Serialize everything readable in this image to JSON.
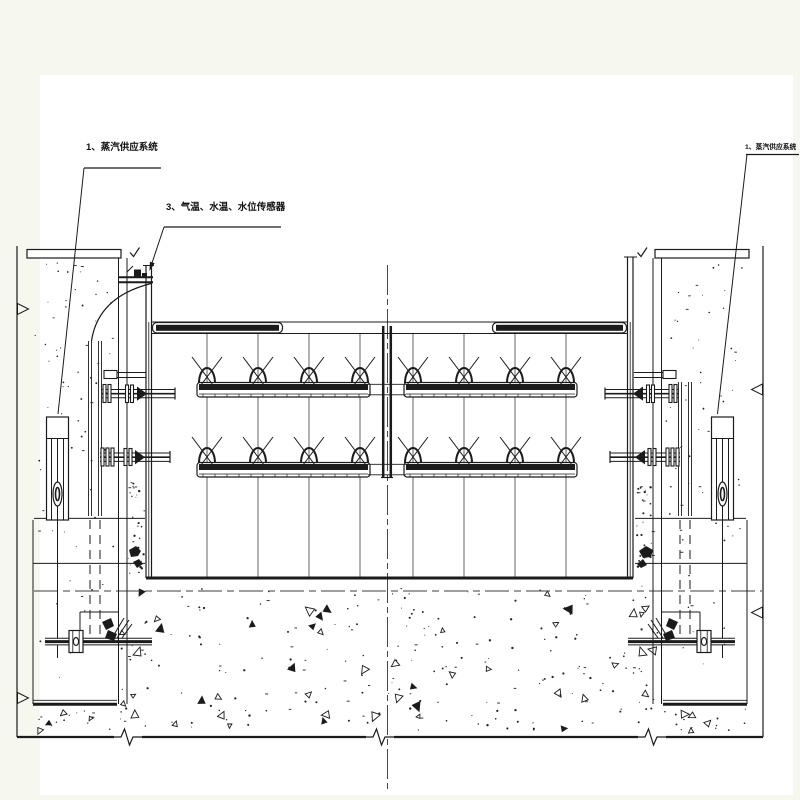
{
  "drawing": {
    "background_color": "#f6f8f0",
    "paper_color": "#ffffff",
    "ink_color": "#1b1b1b",
    "callouts": {
      "left_steam_system": "1、蒸汽供应系统",
      "sensors": "3、气温、水温、水位传感器",
      "right_steam_system": "1、蒸汽供应系统"
    }
  }
}
